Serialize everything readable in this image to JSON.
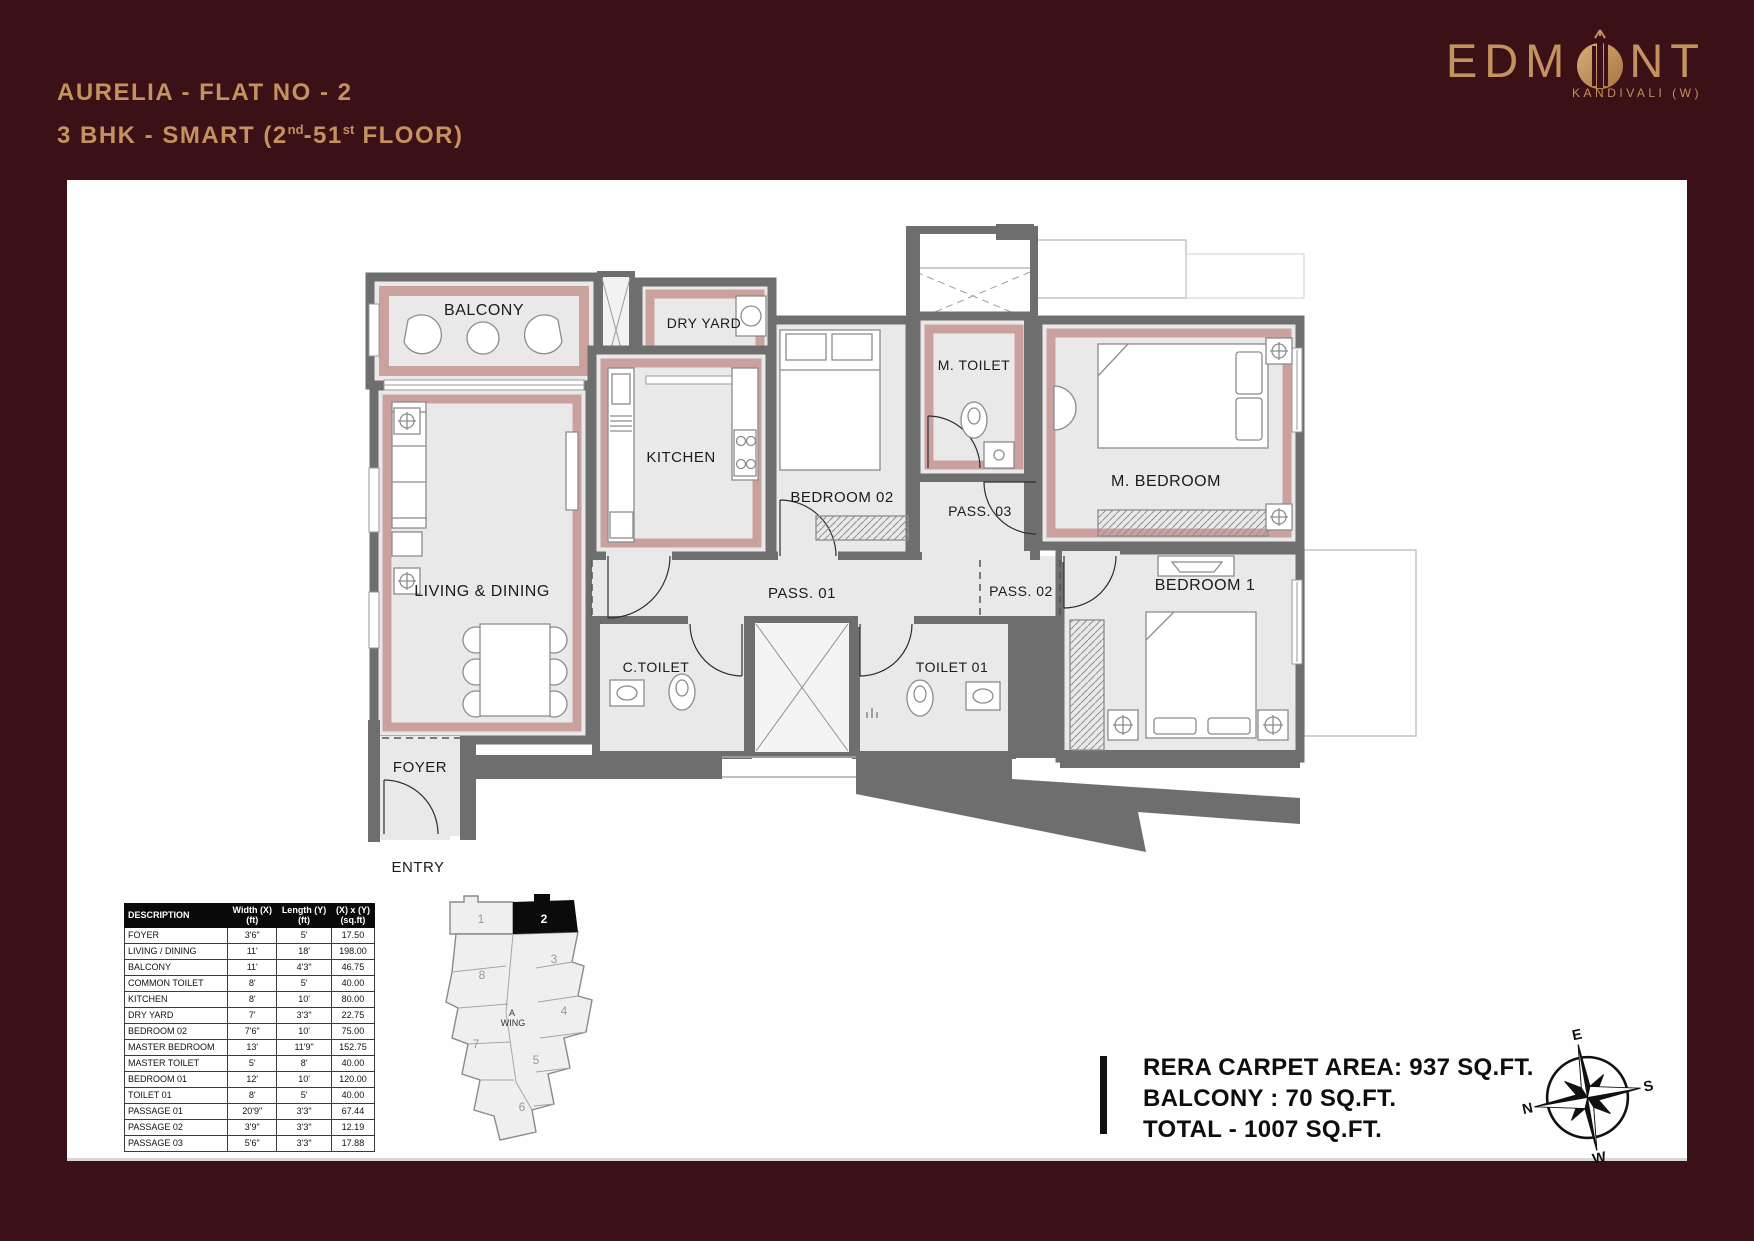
{
  "header": {
    "line1": "AURELIA - FLAT NO - 2",
    "line2_a": "3 BHK - SMART (2",
    "line2_sup1": "nd",
    "line2_b": "-51",
    "line2_sup2": "st",
    "line2_c": " FLOOR)"
  },
  "logo": {
    "part1": "EDM",
    "part2": "NT",
    "location": "KANDIVALI (W)"
  },
  "plan": {
    "labels": {
      "balcony": "BALCONY",
      "dry_yard": "DRY YARD",
      "kitchen": "KITCHEN",
      "bedroom02": "BEDROOM 02",
      "m_toilet": "M. TOILET",
      "pass03": "PASS. 03",
      "m_bedroom": "M. BEDROOM",
      "living_dining": "LIVING & DINING",
      "pass01": "PASS. 01",
      "pass02": "PASS. 02",
      "bedroom1": "BEDROOM 1",
      "c_toilet": "C.TOILET",
      "toilet01": "TOILET 01",
      "foyer": "FOYER",
      "entry": "ENTRY"
    }
  },
  "table": {
    "headers": {
      "description": "DESCRIPTION",
      "width": "Width (X)",
      "width_unit": "(ft)",
      "length": "Length (Y)",
      "length_unit": "(ft)",
      "area": "(X) x (Y)",
      "area_unit": "(sq.ft)"
    },
    "rows": [
      {
        "d": "FOYER",
        "w": "3'6\"",
        "l": "5'",
        "a": "17.50"
      },
      {
        "d": "LIVING / DINING",
        "w": "11'",
        "l": "18'",
        "a": "198.00"
      },
      {
        "d": "BALCONY",
        "w": "11'",
        "l": "4'3\"",
        "a": "46.75"
      },
      {
        "d": "COMMON TOILET",
        "w": "8'",
        "l": "5'",
        "a": "40.00"
      },
      {
        "d": "KITCHEN",
        "w": "8'",
        "l": "10'",
        "a": "80.00"
      },
      {
        "d": "DRY YARD",
        "w": "7'",
        "l": "3'3\"",
        "a": "22.75"
      },
      {
        "d": "BEDROOM 02",
        "w": "7'6\"",
        "l": "10'",
        "a": "75.00"
      },
      {
        "d": "MASTER BEDROOM",
        "w": "13'",
        "l": "11'9\"",
        "a": "152.75"
      },
      {
        "d": "MASTER TOILET",
        "w": "5'",
        "l": "8'",
        "a": "40.00"
      },
      {
        "d": "BEDROOM 01",
        "w": "12'",
        "l": "10'",
        "a": "120.00"
      },
      {
        "d": "TOILET 01",
        "w": "8'",
        "l": "5'",
        "a": "40.00"
      },
      {
        "d": "PASSAGE 01",
        "w": "20'9\"",
        "l": "3'3\"",
        "a": "67.44"
      },
      {
        "d": "PASSAGE 02",
        "w": "3'9\"",
        "l": "3'3\"",
        "a": "12.19"
      },
      {
        "d": "PASSAGE 03",
        "w": "5'6\"",
        "l": "3'3\"",
        "a": "17.88"
      }
    ]
  },
  "keyplan": {
    "wing_line1": "A",
    "wing_line2": "WING",
    "units": [
      "1",
      "2",
      "3",
      "4",
      "5",
      "6",
      "7",
      "8"
    ]
  },
  "areas": {
    "line1": "RERA CARPET AREA: 937 SQ.FT.",
    "line2": "BALCONY : 70 SQ.FT.",
    "line3": "TOTAL - 1007 SQ.FT."
  },
  "compass": {
    "n": "N",
    "e": "E",
    "s": "S",
    "w": "W"
  },
  "colors": {
    "maroon": "#3B1016",
    "gold": "#C4925F",
    "rose": "#CBA19E",
    "wall": "#6E6E6E",
    "floor": "#E9E9E9"
  }
}
